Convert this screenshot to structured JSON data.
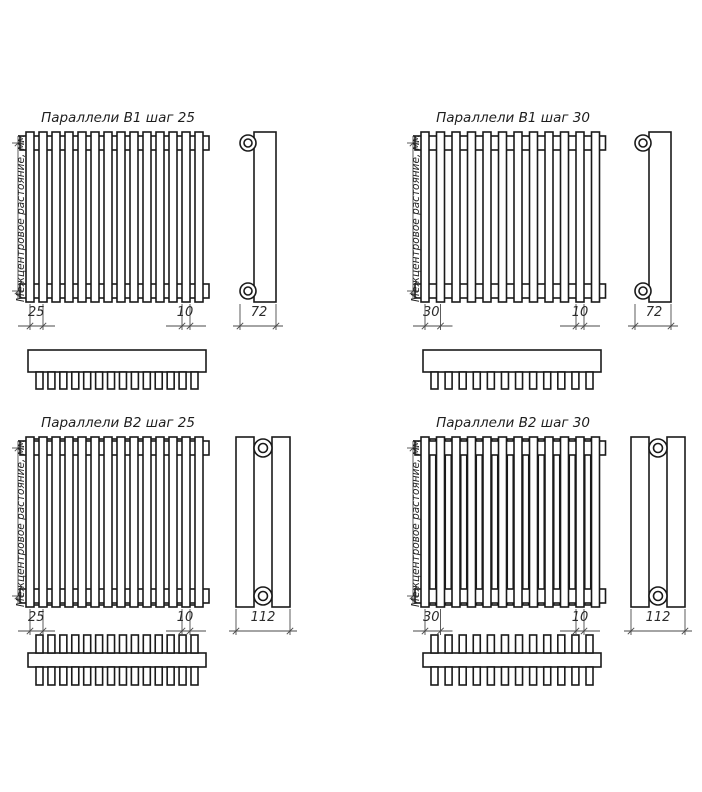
{
  "sheet": {
    "background": "#ffffff"
  },
  "colors": {
    "line": "#1a1a1a",
    "dim": "#4a4a4a"
  },
  "axis_label": "Межцентровое растояние, мм",
  "quadrants": [
    {
      "id": "b1-step-25",
      "title": "Параллели В1 шаг 25",
      "model": "В1",
      "step_mm": 25,
      "tube_count": 14,
      "double_row": false,
      "dims": {
        "pitch": "25",
        "tube_width": "10",
        "depth": "72"
      }
    },
    {
      "id": "b1-step-30",
      "title": "Параллели В1 шаг 30",
      "model": "В1",
      "step_mm": 30,
      "tube_count": 12,
      "double_row": false,
      "dims": {
        "pitch": "30",
        "tube_width": "10",
        "depth": "72"
      }
    },
    {
      "id": "b2-step-25",
      "title": "Параллели В2 шаг 25",
      "model": "В2",
      "step_mm": 25,
      "tube_count": 14,
      "double_row": true,
      "dims": {
        "pitch": "25",
        "tube_width": "10",
        "depth": "112"
      }
    },
    {
      "id": "b2-step-30",
      "title": "Параллели В2 шаг 30",
      "model": "В2",
      "step_mm": 30,
      "tube_count": 12,
      "double_row": true,
      "dims": {
        "pitch": "30",
        "tube_width": "10",
        "depth": "112"
      }
    }
  ]
}
